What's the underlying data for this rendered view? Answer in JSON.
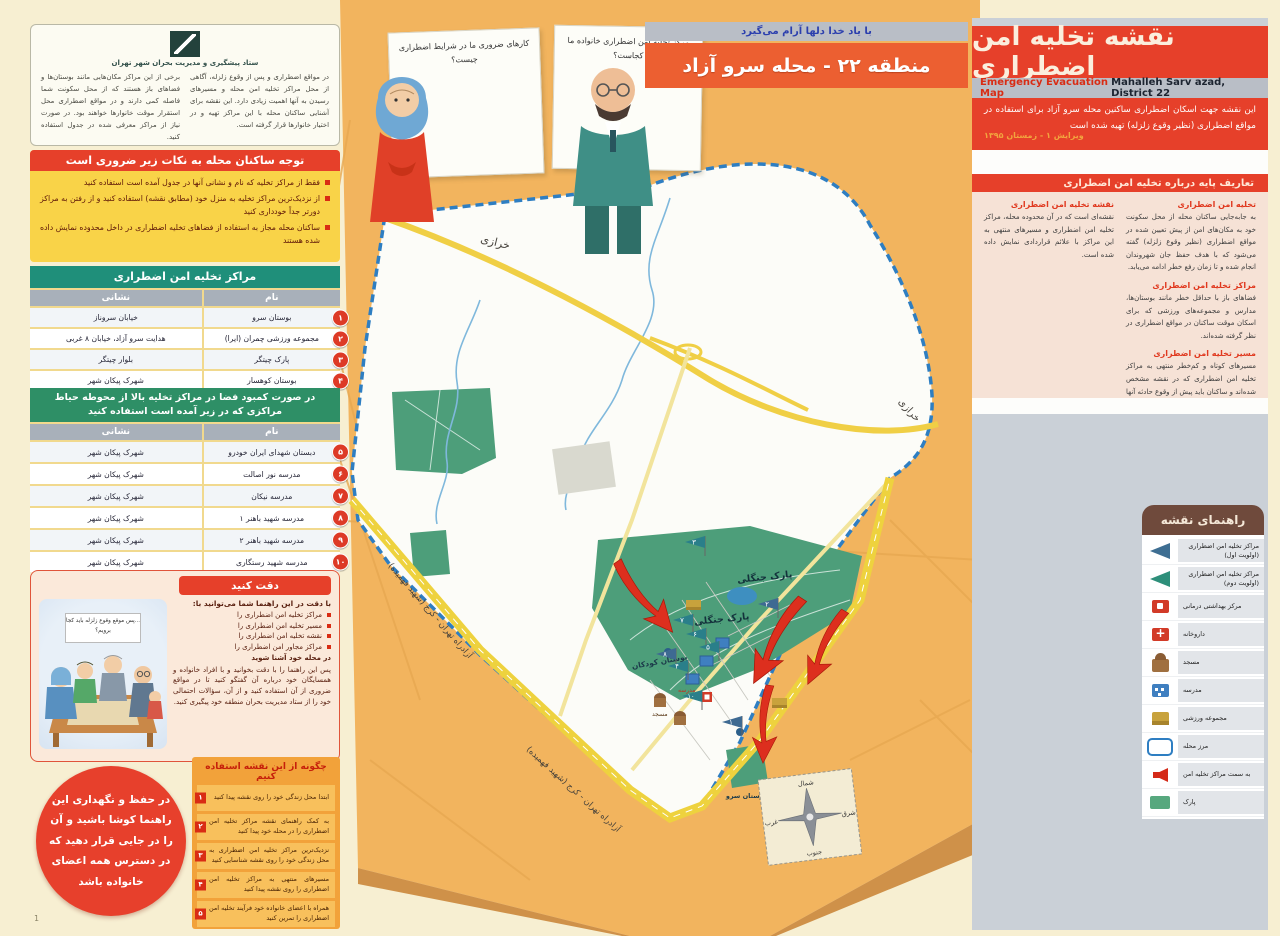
{
  "top": {
    "god_strip": "با یاد خدا دلها آرام می‌گیرد",
    "district_banner": "منطقه ۲۲ - محله سرو آزاد"
  },
  "speech_cards": {
    "left": "کارهای ضروری ما در شرایط اضطراری چیست؟",
    "right": "مرکز تخلیه امن اضطراری خانواده ما کجاست؟"
  },
  "org_box": {
    "org_name": "ستاد پیشگیری و مدیریت بحران شهر تهران",
    "col_right": "در مواقع اضطراری و پس از وقوع زلزله، آگاهی از محل مراکز تخلیه امن محله و مسیرهای رسیدن به آنها اهمیت زیادی دارد. این نقشه برای آشنایی ساکنان محله با این مراکز تهیه و در اختیار خانوارها قرار گرفته است.",
    "col_left": "برخی از این مراکز مکان‌هایی مانند بوستان‌ها و فضاهای باز هستند که از محل سکونت شما فاصله کمی دارند و در مواقع اضطراری محل استقرار موقت خانوارها خواهند بود. در صورت نیاز از مراکز معرفی شده در جدول استفاده کنید."
  },
  "notice_box": {
    "title": "توجه ساکنان محله به نکات زیر ضروری است",
    "bullets": [
      "فقط از مراکز تخلیه که نام و نشانی آنها در جدول آمده است استفاده کنید",
      "از نزدیک‌ترین مراکز تخلیه به منزل خود (مطابق نقشه) استفاده کنید و از رفتن به مراکز دورتر جداً خودداری کنید",
      "ساکنان محله مجاز به استفاده از فضاهای تخلیه اضطراری در داخل محدوده نمایش داده شده هستند"
    ]
  },
  "table1": {
    "title": "مراکز تخلیه امن اضطراری",
    "col_name": "نام",
    "col_address": "نشانی",
    "rows": [
      {
        "no": "۱",
        "name": "بوستان سرو",
        "address": "خیابان سروناز"
      },
      {
        "no": "۲",
        "name": "مجموعه ورزشی چمران (ایرا)",
        "address": "هدایت سرو آزاد، خیابان ۸ غربی"
      },
      {
        "no": "۳",
        "name": "پارک چیتگر",
        "address": "بلوار چیتگر"
      },
      {
        "no": "۴",
        "name": "بوستان کوهسار",
        "address": "شهرک پیکان شهر"
      }
    ]
  },
  "table2": {
    "title": "در صورت کمبود فضا در مراکز تخلیه بالا از محوطه حیاط مراکزی که در زیر آمده است استفاده کنید",
    "col_name": "نام",
    "col_address": "نشانی",
    "rows": [
      {
        "no": "۵",
        "name": "دبستان شهدای ایران خودرو",
        "address": "شهرک پیکان شهر"
      },
      {
        "no": "۶",
        "name": "مدرسه نور اصالت",
        "address": "شهرک پیکان شهر"
      },
      {
        "no": "۷",
        "name": "مدرسه نیکان",
        "address": "شهرک پیکان شهر"
      },
      {
        "no": "۸",
        "name": "مدرسه شهید باهنر ۱",
        "address": "شهرک پیکان شهر"
      },
      {
        "no": "۹",
        "name": "مدرسه شهید باهنر ۲",
        "address": "شهرک پیکان شهر"
      },
      {
        "no": "۱۰",
        "name": "مدرسه شهید رستگاری",
        "address": "شهرک پیکان شهر"
      }
    ]
  },
  "attention_box": {
    "title": "دقت کنید",
    "intro": "با دقت در این راهنما شما می‌توانید با:",
    "bullets": [
      "مراکز تخلیه امن اضطراری را",
      "مسیر تخلیه امن اضطراری را",
      "نقشه تخلیه امن اضطراری را",
      "مراکز مجاور امن اضطراری را"
    ],
    "outro": "در محله خود آشنا شوید",
    "paragraph": "پس این راهنما را با دقت بخوانید و با افراد خانواده و همسایگان خود درباره آن گفتگو کنید تا در مواقع ضروری از آن استفاده کنید و از آن، سؤالات احتمالی خود را از ستاد مدیریت بحران منطقه خود پیگیری کنید.",
    "speech": "...پس موقع وقوع زلزله باید کجا برویم؟"
  },
  "keep_circle": {
    "text": "در حفظ و نگهداری این راهنما کوشا باشید و آن را در جایی قرار دهید که در دسترس همه اعضای خانواده باشد"
  },
  "how_to": {
    "title": "چگونه از این نقشه استفاده کنیم",
    "steps": [
      {
        "no": "۱",
        "text": "ابتدا محل زندگی خود را روی نقشه پیدا کنید"
      },
      {
        "no": "۲",
        "text": "به کمک راهنمای نقشه مراکز تخلیه امن اضطراری را در محله خود پیدا کنید"
      },
      {
        "no": "۳",
        "text": "نزدیک‌ترین مراکز تخلیه امن اضطراری به محل زندگی خود را روی نقشه شناسایی کنید"
      },
      {
        "no": "۴",
        "text": "مسیرهای منتهی به مراکز تخلیه امن اضطراری را روی نقشه پیدا کنید"
      },
      {
        "no": "۵",
        "text": "همراه با اعضای خانواده خود فرآیند تخلیه امن اضطراری را تمرین کنید"
      }
    ]
  },
  "header": {
    "title": "نقشه تخلیه امن اضطراری",
    "subtitle_en": "Emergency Evacuation Map",
    "subtitle_loc": "Mahalleh Sarv azad, District 22",
    "description": "این نقشه جهت اسکان اضطراری ساکنین محله سرو آزاد برای استفاده در مواقع اضطراری (نظیر وقوع زلزله) تهیه شده است",
    "edition": "ویرایش ۱ - زمستان ۱۳۹۵"
  },
  "definitions": {
    "title": "تعاریف پایه درباره تخلیه امن اضطراری",
    "items": [
      {
        "heading": "تخلیه امن اضطراری",
        "body": "به جابه‌جایی ساکنان محله از محل سکونت خود به مکان‌های امن از پیش تعیین شده در مواقع اضطراری (نظیر وقوع زلزله) گفته می‌شود که با هدف حفظ جان شهروندان انجام شده و تا زمان رفع خطر ادامه می‌یابد."
      },
      {
        "heading": "مراکز تخلیه امن اضطراری",
        "body": "فضاهای باز با حداقل خطر مانند بوستان‌ها، مدارس و مجموعه‌های ورزشی که برای اسکان موقت ساکنان در مواقع اضطراری در نظر گرفته شده‌اند."
      },
      {
        "heading": "مسیر تخلیه امن اضطراری",
        "body": "مسیرهای کوتاه و کم‌خطر منتهی به مراکز تخلیه امن اضطراری که در نقشه مشخص شده‌اند و ساکنان باید پیش از وقوع حادثه آنها را به خوبی شناسایی کنند."
      },
      {
        "heading": "نقشه تخلیه امن اضطراری",
        "body": "نقشه‌ای است که در آن محدوده محله، مراکز تخلیه امن اضطراری و مسیرهای منتهی به این مراکز با علائم قراردادی نمایش داده شده است."
      }
    ]
  },
  "legend": {
    "title": "راهنمای نقشه",
    "items": [
      {
        "icon": "flag-priority-1",
        "label": "مراکز تخلیه امن اضطراری (اولویت اول)"
      },
      {
        "icon": "flag-priority-2",
        "label": "مراکز تخلیه امن اضطراری (اولویت دوم)"
      },
      {
        "icon": "health-center",
        "label": "مرکز بهداشتی درمانی"
      },
      {
        "icon": "pharmacy",
        "label": "داروخانه"
      },
      {
        "icon": "mosque",
        "label": "مسجد"
      },
      {
        "icon": "school",
        "label": "مدرسه"
      },
      {
        "icon": "sports-complex",
        "label": "مجموعه ورزشی"
      },
      {
        "icon": "neighborhood-border",
        "label": "مرز محله"
      },
      {
        "icon": "evacuation-arrow",
        "label": "به سمت مراکز تخلیه امن"
      },
      {
        "icon": "park",
        "label": "پارک"
      }
    ]
  },
  "map": {
    "labels": {
      "kharazi": "خرازی",
      "kharazi2": "خرازی",
      "freeway": "آزادراه تهران - کرج (شهید فهمیده)",
      "freeway2": "آزادراه تهران - کرج (شهید فهمیده)",
      "forest_park": "پارک جنگلی",
      "forest_park2": "پارک جنگلی",
      "children_park": "بوستان کودکان",
      "sarv_park": "بوستان سرو",
      "mosque": "مسجد",
      "school": "مدرسه"
    },
    "compass": {
      "n": "شمال",
      "s": "جنوب",
      "e": "شرق",
      "w": "غرب"
    },
    "flags": [
      "۳",
      "۲",
      "۷",
      "۶",
      "۵",
      "۸",
      "۴",
      "۱",
      "۱۰"
    ]
  },
  "page_number": "1"
}
